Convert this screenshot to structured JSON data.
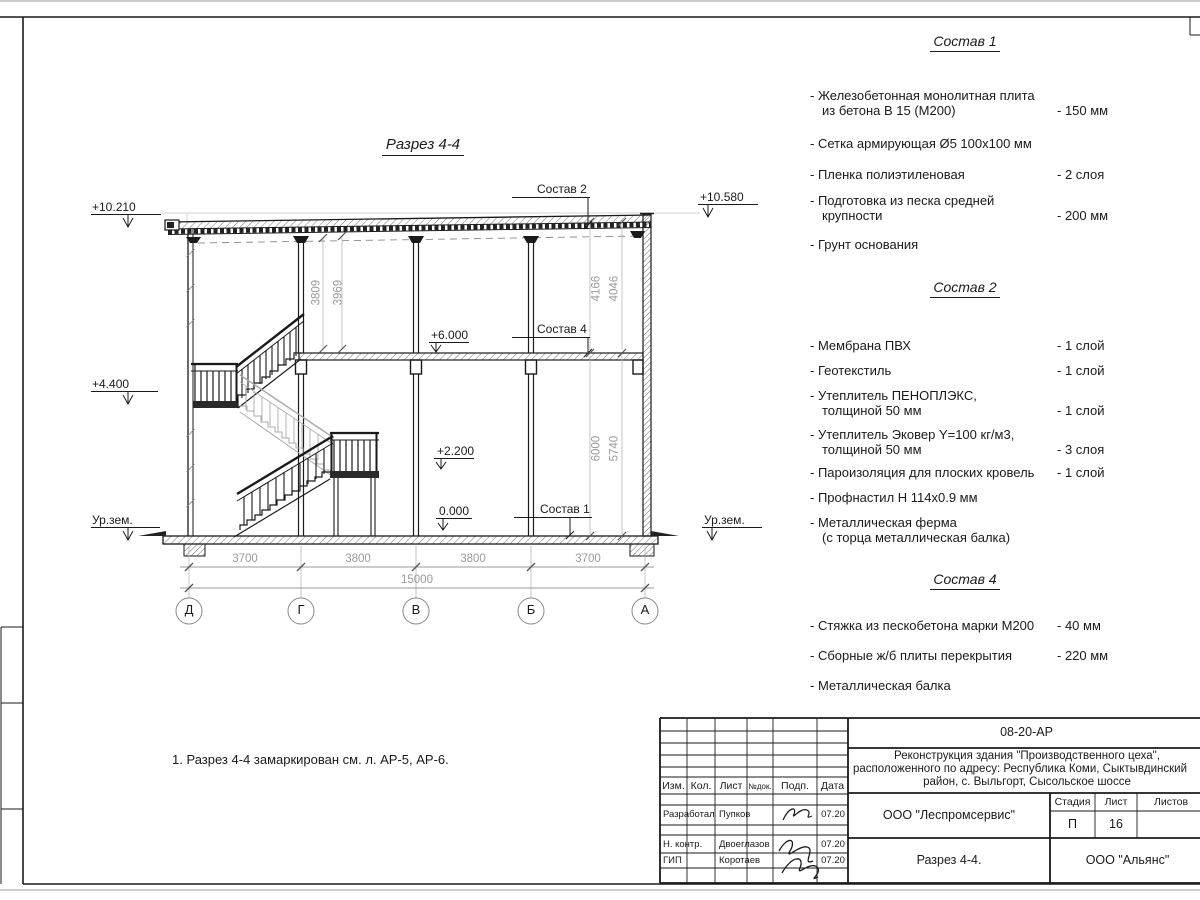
{
  "sheet": {
    "title": "Разрез 4-4",
    "note": "1. Разрез 4-4 замаркирован см. л. АР-5, АР-6."
  },
  "colors": {
    "ink": "#1a1a1a",
    "dim_gray": "#9a9a9a"
  },
  "drawing": {
    "elevations": {
      "left_top": "+10.210",
      "left_mid": "+4.400",
      "ground_left": "Ур.зем.",
      "right_top": "+10.580",
      "ground_right": "Ур.зем.",
      "floor2": "+6.000",
      "landing": "+2.200",
      "floor1": "0.000"
    },
    "callouts": {
      "roof": "Состав 2",
      "floor2": "Состав 4",
      "floor1": "Состав 1"
    },
    "axes": [
      "Д",
      "Г",
      "В",
      "Б",
      "А"
    ],
    "dims": {
      "spans": [
        "3700",
        "3800",
        "3800",
        "3700"
      ],
      "total": "15000",
      "mid_heights": [
        "3809",
        "3969"
      ],
      "right_top_heights": [
        "4166",
        "4046"
      ],
      "right_bottom_heights": [
        "6000",
        "5740"
      ]
    }
  },
  "compositions": [
    {
      "title": "Состав 1",
      "items": [
        {
          "name": "- Железобетонная  монолитная плита",
          "name2": "из бетона В 15 (М200)",
          "value": "- 150 мм"
        },
        {
          "name": "- Сетка армирующая Ø5 100х100 мм",
          "name2": "",
          "value": ""
        },
        {
          "name": "- Пленка полиэтиленовая",
          "name2": "",
          "value": "- 2 слоя"
        },
        {
          "name": "- Подготовка из песка средней",
          "name2": "крупности",
          "value": "- 200 мм"
        },
        {
          "name": "- Грунт основания",
          "name2": "",
          "value": ""
        }
      ]
    },
    {
      "title": "Состав 2",
      "items": [
        {
          "name": "- Мембрана ПВХ",
          "name2": "",
          "value": "- 1 слой"
        },
        {
          "name": "- Геотекстиль",
          "name2": "",
          "value": "- 1 слой"
        },
        {
          "name": "- Утеплитель ПЕНОПЛЭКС,",
          "name2": "толщиной 50 мм",
          "value": "- 1 слой"
        },
        {
          "name": "- Утеплитель Эковер Y=100 кг/м3,",
          "name2": "толщиной 50 мм",
          "value": "- 3 слоя"
        },
        {
          "name": "- Пароизоляция для плоских кровель",
          "name2": "",
          "value": "- 1 слой"
        },
        {
          "name": "- Профнастил Н 114х0.9 мм",
          "name2": "",
          "value": ""
        },
        {
          "name": "- Металлическая ферма",
          "name2": "(с торца металлическая балка)",
          "value": ""
        }
      ]
    },
    {
      "title": "Состав 4",
      "items": [
        {
          "name": "- Стяжка из пескобетона марки М200",
          "name2": "",
          "value": "- 40 мм"
        },
        {
          "name": "- Сборные ж/б плиты перекрытия",
          "name2": "",
          "value": "- 220 мм"
        },
        {
          "name": "- Металлическая балка",
          "name2": "",
          "value": ""
        }
      ]
    }
  ],
  "titleblock": {
    "doc_number": "08-20-АР",
    "project_line1": "Реконструкция здания \"Производственного цеха\",",
    "project_line2": "расположенного по адресу: Республика Коми, Сыктывдинский",
    "project_line3": "район, с. Выльгорт, Сысольское шоссе",
    "columns": {
      "izm": "Изм.",
      "kol": "Кол.",
      "list": "Лист",
      "ndoc": "№док.",
      "podp": "Подп.",
      "data": "Дата"
    },
    "rows": [
      {
        "role": "Разработал",
        "name": "Пупков",
        "date": "07.20"
      },
      {
        "role": "Н. контр.",
        "name": "Двоеглазов",
        "date": "07.20"
      },
      {
        "role": "ГИП",
        "name": "Коротаев",
        "date": "07.20"
      }
    ],
    "org": "ООО \"Леспромсервис\"",
    "stage_label": "Стадия",
    "sheet_label": "Лист",
    "sheets_label": "Листов",
    "stage": "П",
    "sheet_no": "16",
    "drawing_name": "Разрез 4-4.",
    "contractor": "ООО \"Альянс\""
  }
}
